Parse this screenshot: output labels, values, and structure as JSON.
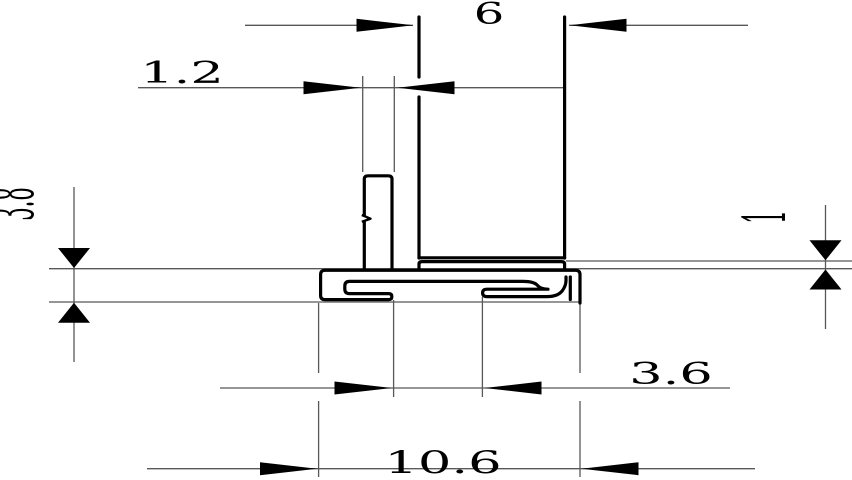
{
  "drawing": {
    "background_color": "#ffffff",
    "outline_color": "#000000",
    "thin_line_color": "#58585a",
    "labels": {
      "glass_width": "6",
      "fin_thickness": "1.2",
      "section_height": "3.8",
      "ledge_height": "1",
      "slot_opening": "3.6",
      "overall_width": "10.6"
    }
  }
}
